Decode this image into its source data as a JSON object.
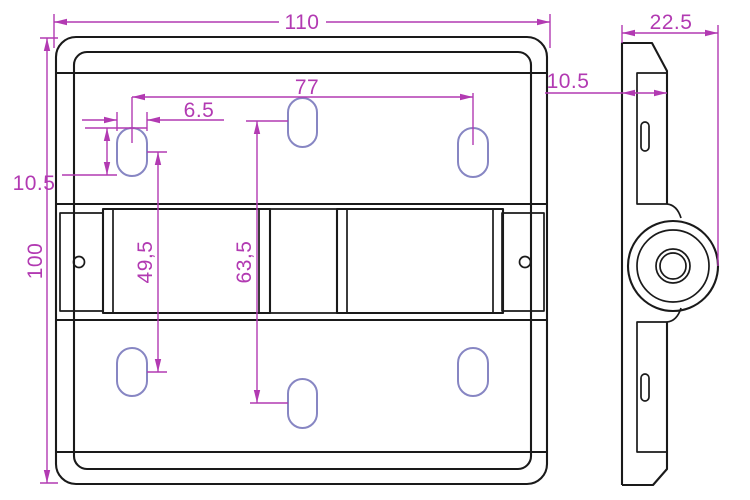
{
  "front_view": {
    "width_label": "110",
    "height_label": "100",
    "slot_span_label": "77",
    "slot_width_label": "6.5",
    "slot_height_label": "10.5",
    "outer_slots_spacing_label": "49,5",
    "middle_slots_spacing_label": "63,5"
  },
  "side_view": {
    "depth_label": "22.5",
    "thickness_label": "10.5"
  },
  "colors": {
    "outline": "#1a1a1a",
    "dimension": "#b23ab2",
    "slot": "#8786c3"
  }
}
